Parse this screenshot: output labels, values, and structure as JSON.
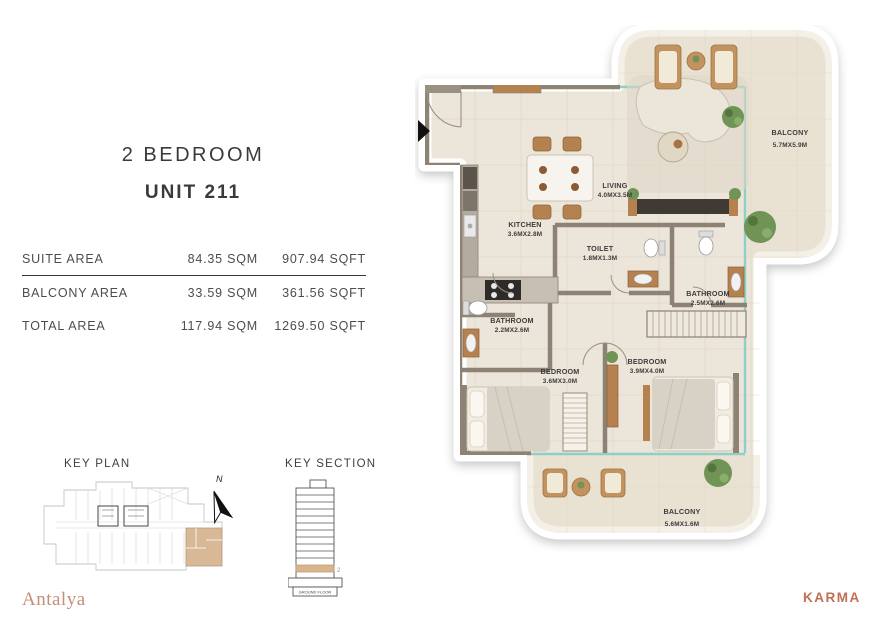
{
  "header": {
    "title": "2 BEDROOM",
    "unit": "UNIT 211"
  },
  "area_table": {
    "rows": [
      {
        "label": "SUITE AREA",
        "sqm": "84.35 SQM",
        "sqft": "907.94 SQFT"
      },
      {
        "label": "BALCONY AREA",
        "sqm": "33.59 SQM",
        "sqft": "361.56 SQFT"
      },
      {
        "label": "TOTAL AREA",
        "sqm": "117.94 SQM",
        "sqft": "1269.50 SQFT"
      }
    ]
  },
  "key_plan": {
    "title": "KEY PLAN",
    "north": "N"
  },
  "key_section": {
    "title": "KEY SECTION",
    "level_label": "2",
    "base_label": "GROUND FLOOR"
  },
  "brands": {
    "community": "Antalya",
    "developer": "KARMA"
  },
  "floor_plan": {
    "rooms": {
      "kitchen": {
        "name": "KITCHEN",
        "dims": "3.6MX2.8M"
      },
      "living": {
        "name": "LIVING",
        "dims": "4.0MX3.5M"
      },
      "toilet": {
        "name": "TOILET",
        "dims": "1.8MX1.3M"
      },
      "bathroom_main": {
        "name": "BATHROOM",
        "dims": "2.5MX2.6M"
      },
      "bathroom_second": {
        "name": "BATHROOM",
        "dims": "2.2MX2.6M"
      },
      "bedroom_first": {
        "name": "BEDROOM",
        "dims": "3.6MX3.0M"
      },
      "bedroom_master": {
        "name": "BEDROOM",
        "dims": "3.9MX4.0M"
      },
      "balcony_main": {
        "name": "BALCONY",
        "dims": "5.7MX5.9M"
      },
      "balcony_second": {
        "name": "BALCONY",
        "dims": "5.6MX1.6M"
      }
    },
    "colors": {
      "floor_beige": "#ece5d9",
      "wall_taupe": "#8d8273",
      "glass_teal": "#8ecfc6",
      "wood": "#b5824f",
      "highlight_tan": "#d9b897",
      "brand_copper": "#bf7053",
      "brand_rose": "#c68e77"
    }
  }
}
